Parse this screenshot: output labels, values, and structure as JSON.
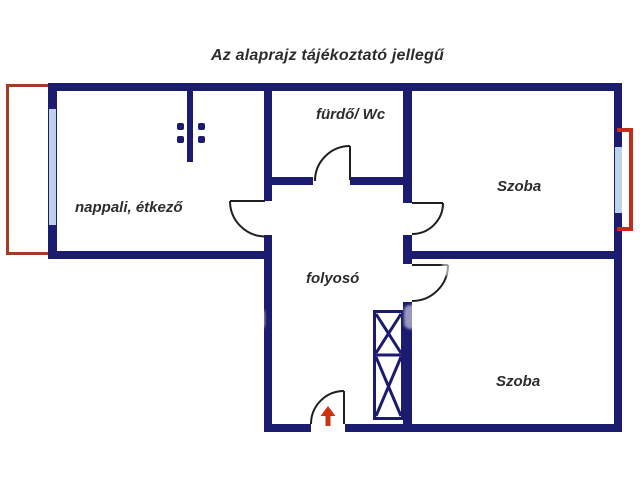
{
  "title": "Az alaprajz tájékoztató jellegű",
  "rooms": {
    "living": {
      "label": "nappali, étkező"
    },
    "bathroom": {
      "label": "fürdő/ Wc"
    },
    "room_top": {
      "label": "Szoba"
    },
    "hallway": {
      "label": "folyosó"
    },
    "room_bottom": {
      "label": "Szoba"
    }
  },
  "colors": {
    "wall": "#1b1b70",
    "window": "#bdd3ea",
    "balcony_outline": "#a63a22",
    "window_marker": "#c52b18",
    "entrance_arrow": "#cc3311",
    "door_line": "#1f1f1f",
    "label": "#2d2d2d"
  },
  "entrance": {
    "direction": "up"
  },
  "icons": {
    "entrance_arrow": "up-arrow-icon",
    "wardrobe": "crossed-box-wardrobe",
    "opening_dots": "4-dot-opening-marker"
  }
}
